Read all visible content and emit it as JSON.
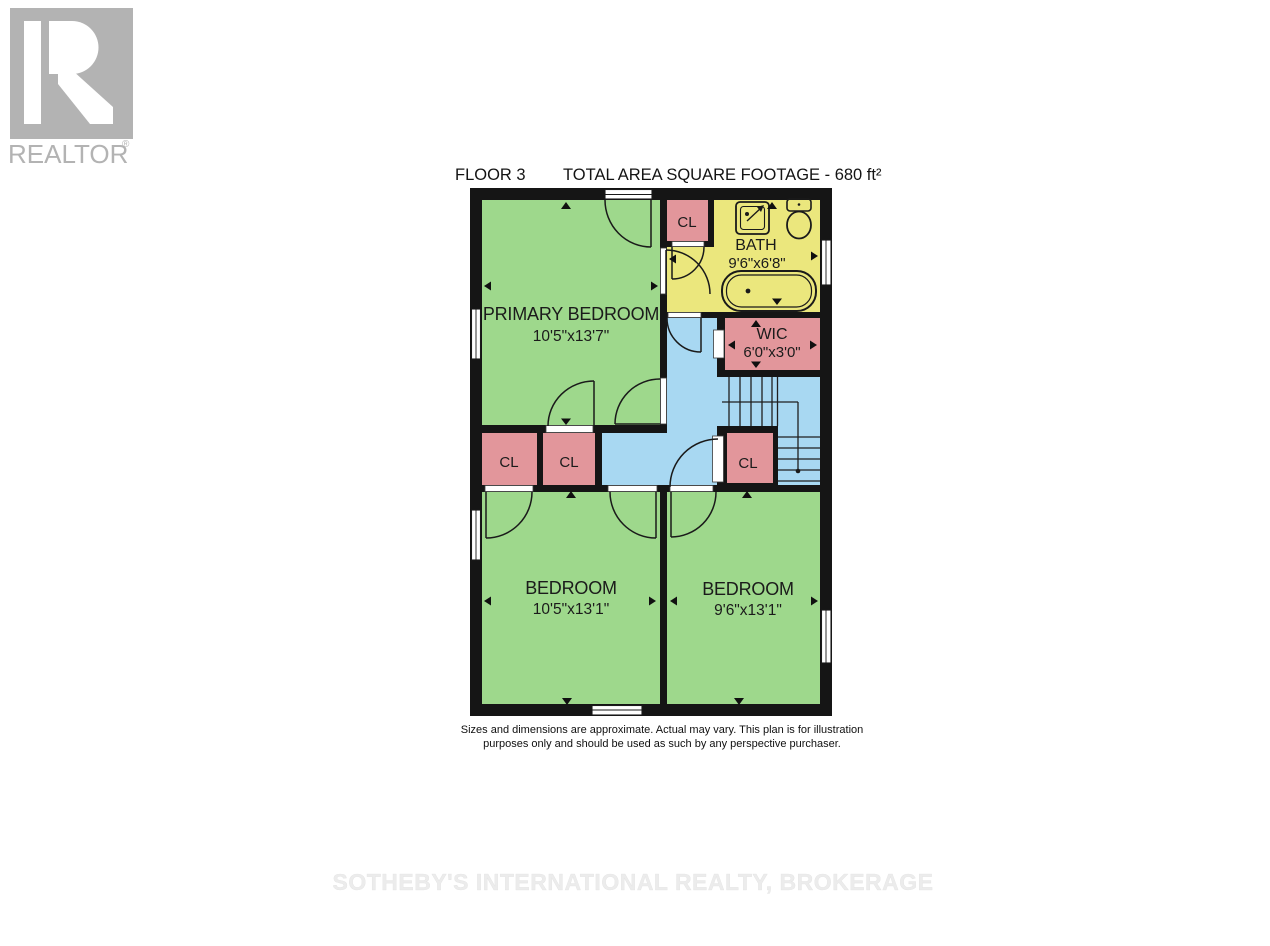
{
  "logo": {
    "brand": "REALTOR",
    "registered": "®"
  },
  "header": {
    "floor_label": "FLOOR 3",
    "area_label": "TOTAL AREA SQUARE FOOTAGE - 680 ft²"
  },
  "rooms": {
    "primary_bedroom": {
      "name": "PRIMARY BEDROOM",
      "dims": "10'5\"x13'7\""
    },
    "bath": {
      "name": "BATH",
      "dims": "9'6\"x6'8\""
    },
    "wic": {
      "name": "WIC",
      "dims": "6'0\"x3'0\""
    },
    "bedroom_left": {
      "name": "BEDROOM",
      "dims": "10'5\"x13'1\""
    },
    "bedroom_right": {
      "name": "BEDROOM",
      "dims": "9'6\"x13'1\""
    }
  },
  "closets": {
    "top": "CL",
    "left_a": "CL",
    "left_b": "CL",
    "right": "CL"
  },
  "disclaimer": {
    "line1": "Sizes and dimensions are approximate. Actual may vary. This plan is for illustration",
    "line2": "purposes only and should be used as such by any perspective purchaser."
  },
  "watermark": {
    "text": "SOTHEBY'S INTERNATIONAL REALTY, BROKERAGE"
  },
  "colors": {
    "room_green": "#9ed88c",
    "bath_yellow": "#ebe77d",
    "closet_pink": "#e2969b",
    "hall_blue": "#a8d8f2",
    "wall": "#151515",
    "logo_gray": "#b3b3b3",
    "watermark_gray": "#ececec"
  }
}
